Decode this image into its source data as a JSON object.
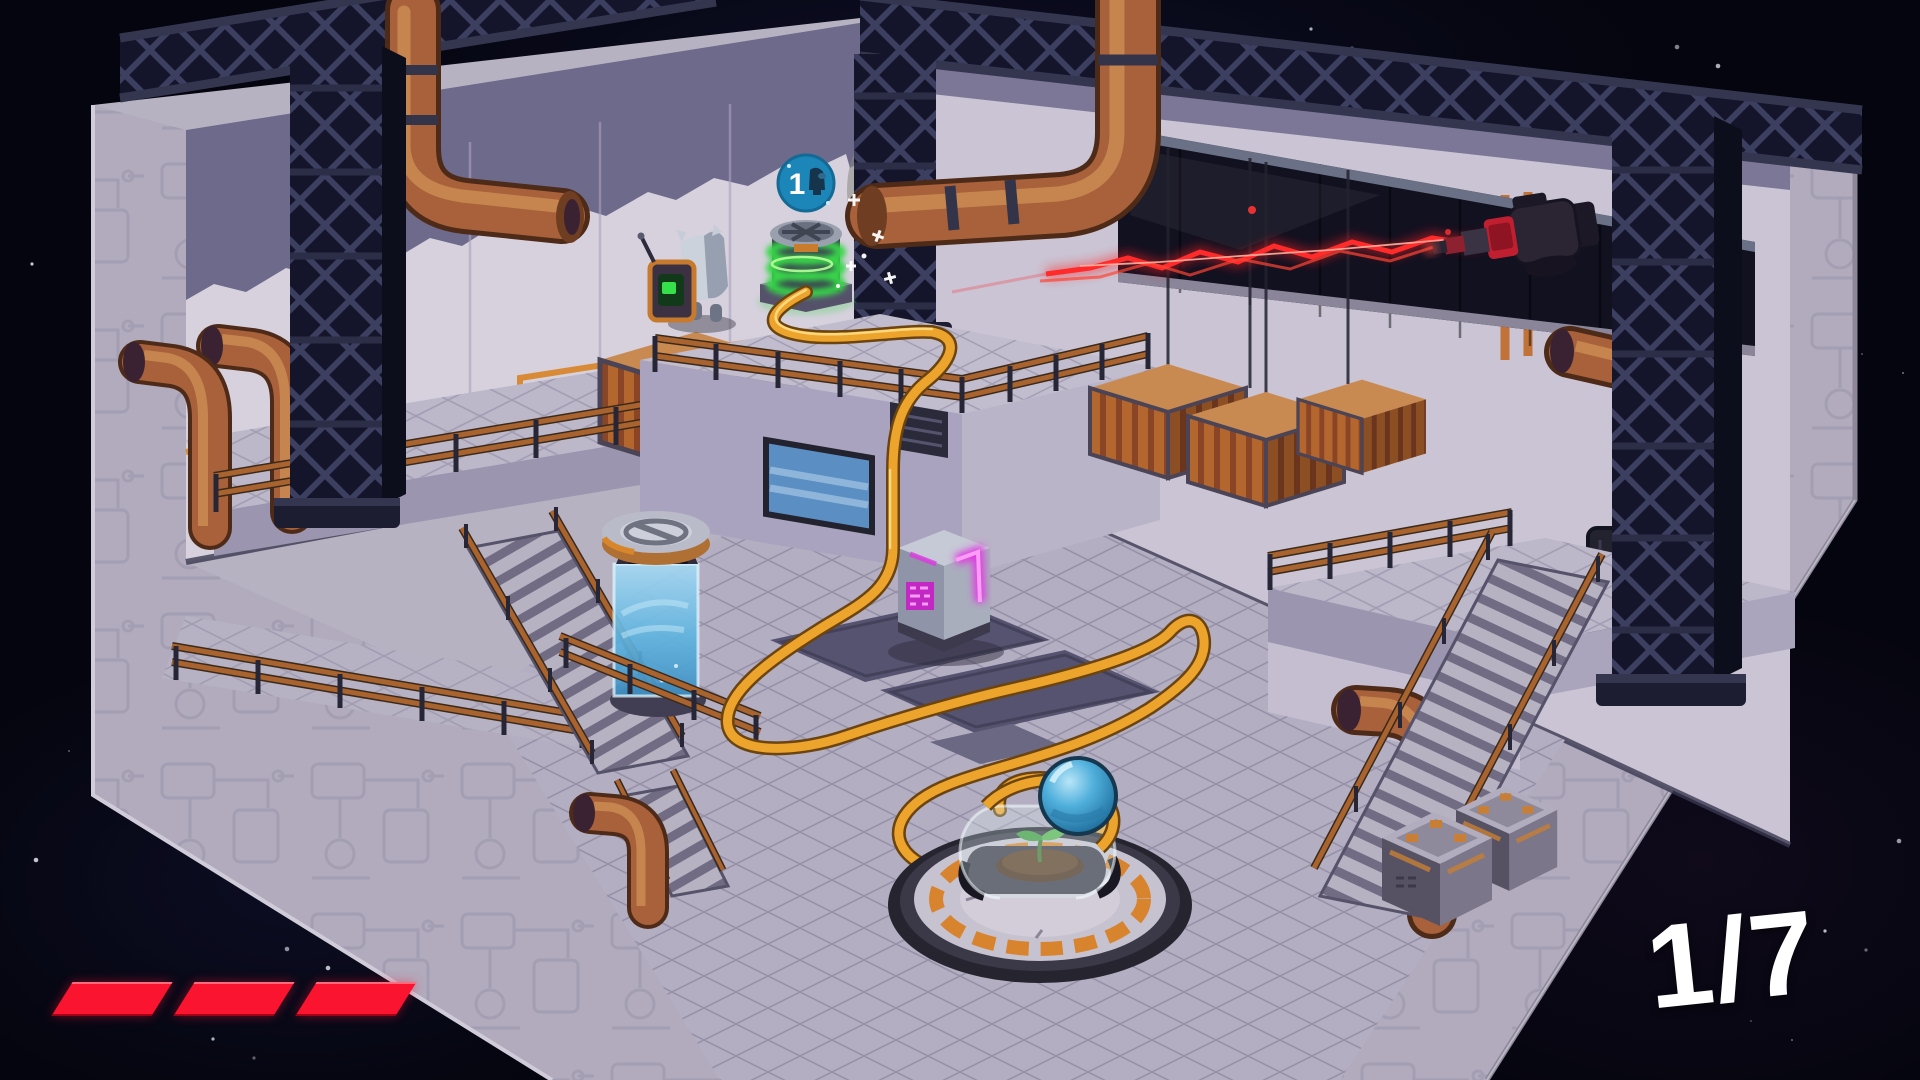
{
  "ui": {
    "level_counter": {
      "label": "1/7",
      "current": 1,
      "total": 7
    },
    "lives": {
      "count": 3,
      "symbol": "red-dash"
    }
  },
  "scene": {
    "crew_badge": {
      "value": "1",
      "icon": "crewmate-icon"
    },
    "colors": {
      "space": "#05050f",
      "hull": "#b7b2c1",
      "wall": "#d4cfdc",
      "wall_shadow": "#6e6a8b",
      "floor": "#b3aec1",
      "truss_dark": "#14152a",
      "pipe_copper": "#a8613a",
      "container_orange": "#bf6a36",
      "railing_copper": "#a9632f",
      "cable_yellow": "#eda42c",
      "laser_red": "#ff2a2a",
      "accent_orange": "#d8862c",
      "coil_green": "#3cd64b",
      "machine_magenta": "#e03ae2",
      "tank_blue": "#7cc1e8",
      "badge_blue": "#1d86b9",
      "ui_red": "#fa1430",
      "text_white": "#ffffff"
    }
  }
}
